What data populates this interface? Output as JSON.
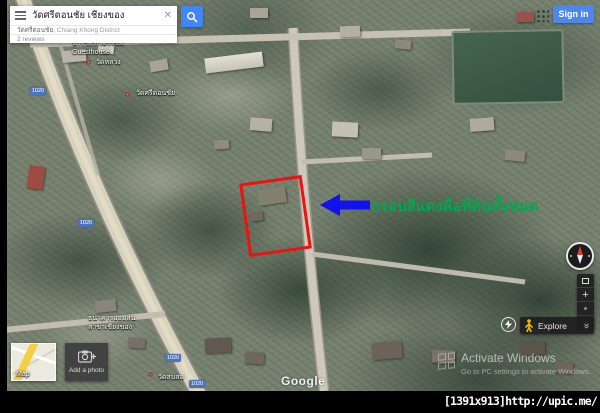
{
  "search": {
    "query": "วัดศรีดอนชัย เชียงของ",
    "suggestion_primary": "วัดศรีดอนชัย,",
    "suggestion_secondary": " Chiang Khong District",
    "reviews": "2 reviews"
  },
  "header": {
    "sign_in": "Sign in"
  },
  "annotation": {
    "note": "กรอบสีแดงคือที่ดินทั้งหมด",
    "note_color": "#00a84e",
    "box_color": "#ee1111",
    "arrow_color": "#1212ee"
  },
  "map": {
    "shield": "1020",
    "google": "Google",
    "labels": {
      "guesthouse_1": "น้ำโขงริเวอร์ไซด์",
      "guesthouse_2": "Guesthouse",
      "poi_1": "วัดหลวง",
      "poi_2": "วัดศรีดอนชัย",
      "bank_1": "ธนาคารออมสิน",
      "bank_2": "สาขาเชียงของ",
      "poi_3": "วัดสบสม"
    }
  },
  "controls": {
    "explore": "Explore",
    "map_label": "Map",
    "add_photo": "Add a photo",
    "zoom_in": "+",
    "zoom_out": "−"
  },
  "watermark": {
    "line1": "Activate Windows",
    "line2": "Go to PC settings to activate Windows."
  },
  "footer": {
    "tag": "[1391x913]http://upic.me/"
  }
}
